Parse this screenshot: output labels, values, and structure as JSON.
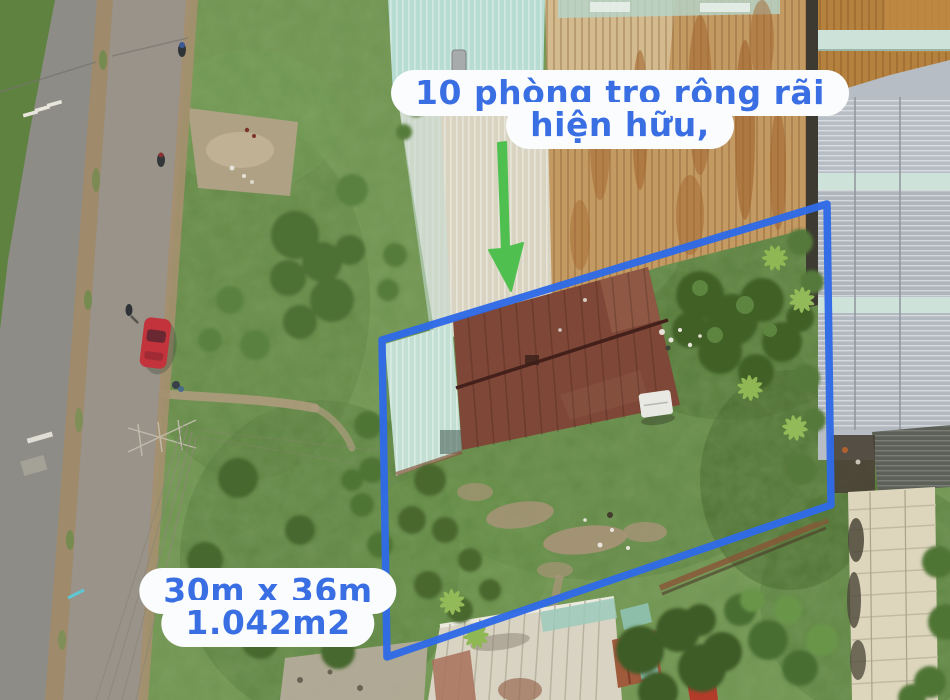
{
  "annotations": {
    "callout": {
      "line1": "10 phòng trọ rộng rãi",
      "line2": "hiện hữu,"
    },
    "dimensions": {
      "line1": "30m x 36m",
      "line2": "1.042m2"
    }
  },
  "overlay": {
    "boundary_points": "382,340 827,204 831,505 387,657",
    "boundary_color": "#2f6ae6",
    "arrow_color": "#4fc04f",
    "text_color": "#3a6fe4",
    "bubble_color": "#fbfcfe"
  },
  "scene": {
    "description": "aerial drone photo of a land plot with existing rental rooms, road on the left, neighbouring metal roofs",
    "colors": {
      "grass": "#6f9350",
      "tree_dark": "#3f6128",
      "road": "#8d8c86",
      "median_dirt": "#a08a6c",
      "rust_roof": "#c49a63",
      "brown_roof": "#7e4737",
      "teal_roof": "#b7dcd2",
      "silver_roof": "#b6bdc4",
      "cream_roof": "#d8d3c3",
      "red_car": "#c2333c"
    }
  }
}
